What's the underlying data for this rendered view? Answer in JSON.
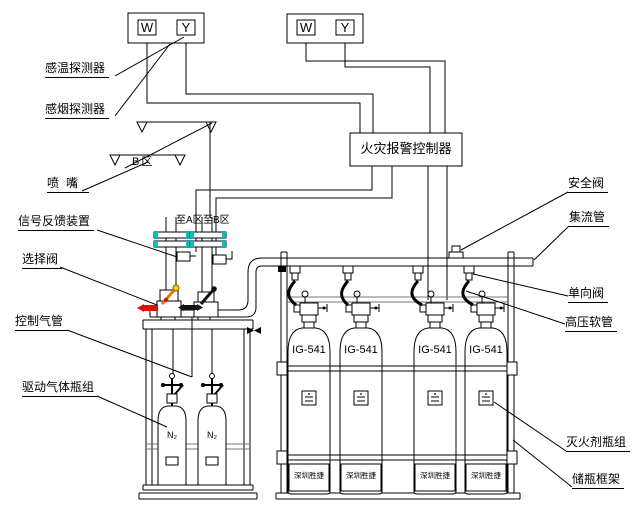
{
  "colors": {
    "line": "#000000",
    "background": "#ffffff",
    "flange_seal": "#00c2c2",
    "valve_open_red": "#e01000",
    "valve_lever_orange": "#d98000",
    "valve_lever_tip_yellow": "#ffd400",
    "valve_closed_black": "#111111"
  },
  "detectors": {
    "left_group": {
      "heat_symbol": "W",
      "smoke_symbol": "Y"
    },
    "right_group": {
      "heat_symbol": "W",
      "smoke_symbol": "Y"
    }
  },
  "controller": {
    "label": "火灾报警控制器"
  },
  "zones": {
    "zone_b_label": "B区",
    "to_zone_a": "至A区",
    "to_zone_b": "至B区"
  },
  "callouts": {
    "heat_detector": "感温探测器",
    "smoke_detector": "感烟探测器",
    "nozzle": "喷嘴",
    "signal_feedback": "信号反馈装置",
    "selector_valve": "选择阀",
    "control_tube": "控制气管",
    "drive_gas_cylinders": "驱动气体瓶组",
    "safety_valve": "安全阀",
    "collecting_pipe": "集流管",
    "check_valve": "单向阀",
    "hp_hose": "高压软管",
    "agent_cylinders": "灭火剂瓶组",
    "cylinder_frame": "储瓶框架"
  },
  "agent_cylinders": [
    {
      "name": "IG-541",
      "brand": "深圳胜捷"
    },
    {
      "name": "IG-541",
      "brand": "深圳胜捷"
    },
    {
      "name": "IG-541",
      "brand": "深圳胜捷"
    },
    {
      "name": "IG-541",
      "brand": "深圳胜捷"
    }
  ],
  "drive_cylinders": [
    {
      "name": "N₂"
    },
    {
      "name": "N₂"
    }
  ]
}
